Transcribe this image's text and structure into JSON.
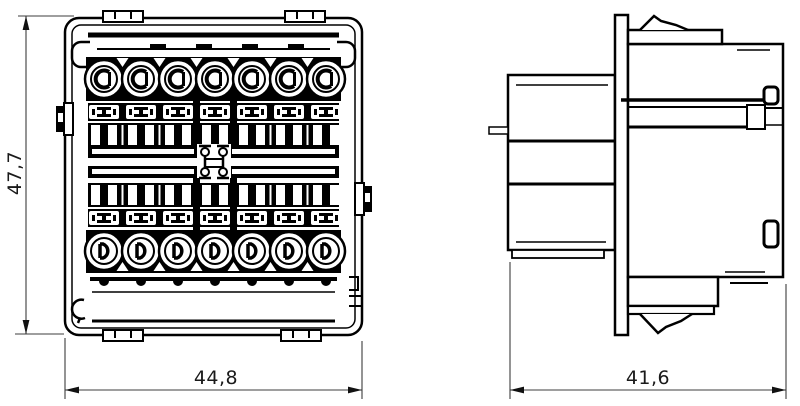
{
  "drawing": {
    "type": "technical-dimension-drawing",
    "subject": "connector-module-two-views",
    "colors": {
      "line": "#000000",
      "dimension_line": "#3d3d3d",
      "text": "#1a1a1a",
      "background": "#ffffff"
    },
    "front_view": {
      "height": "47,7",
      "width": "44,8",
      "terminal_count_top_row": 7,
      "terminal_count_bottom_row": 7
    },
    "side_view": {
      "width": "41,6"
    }
  }
}
